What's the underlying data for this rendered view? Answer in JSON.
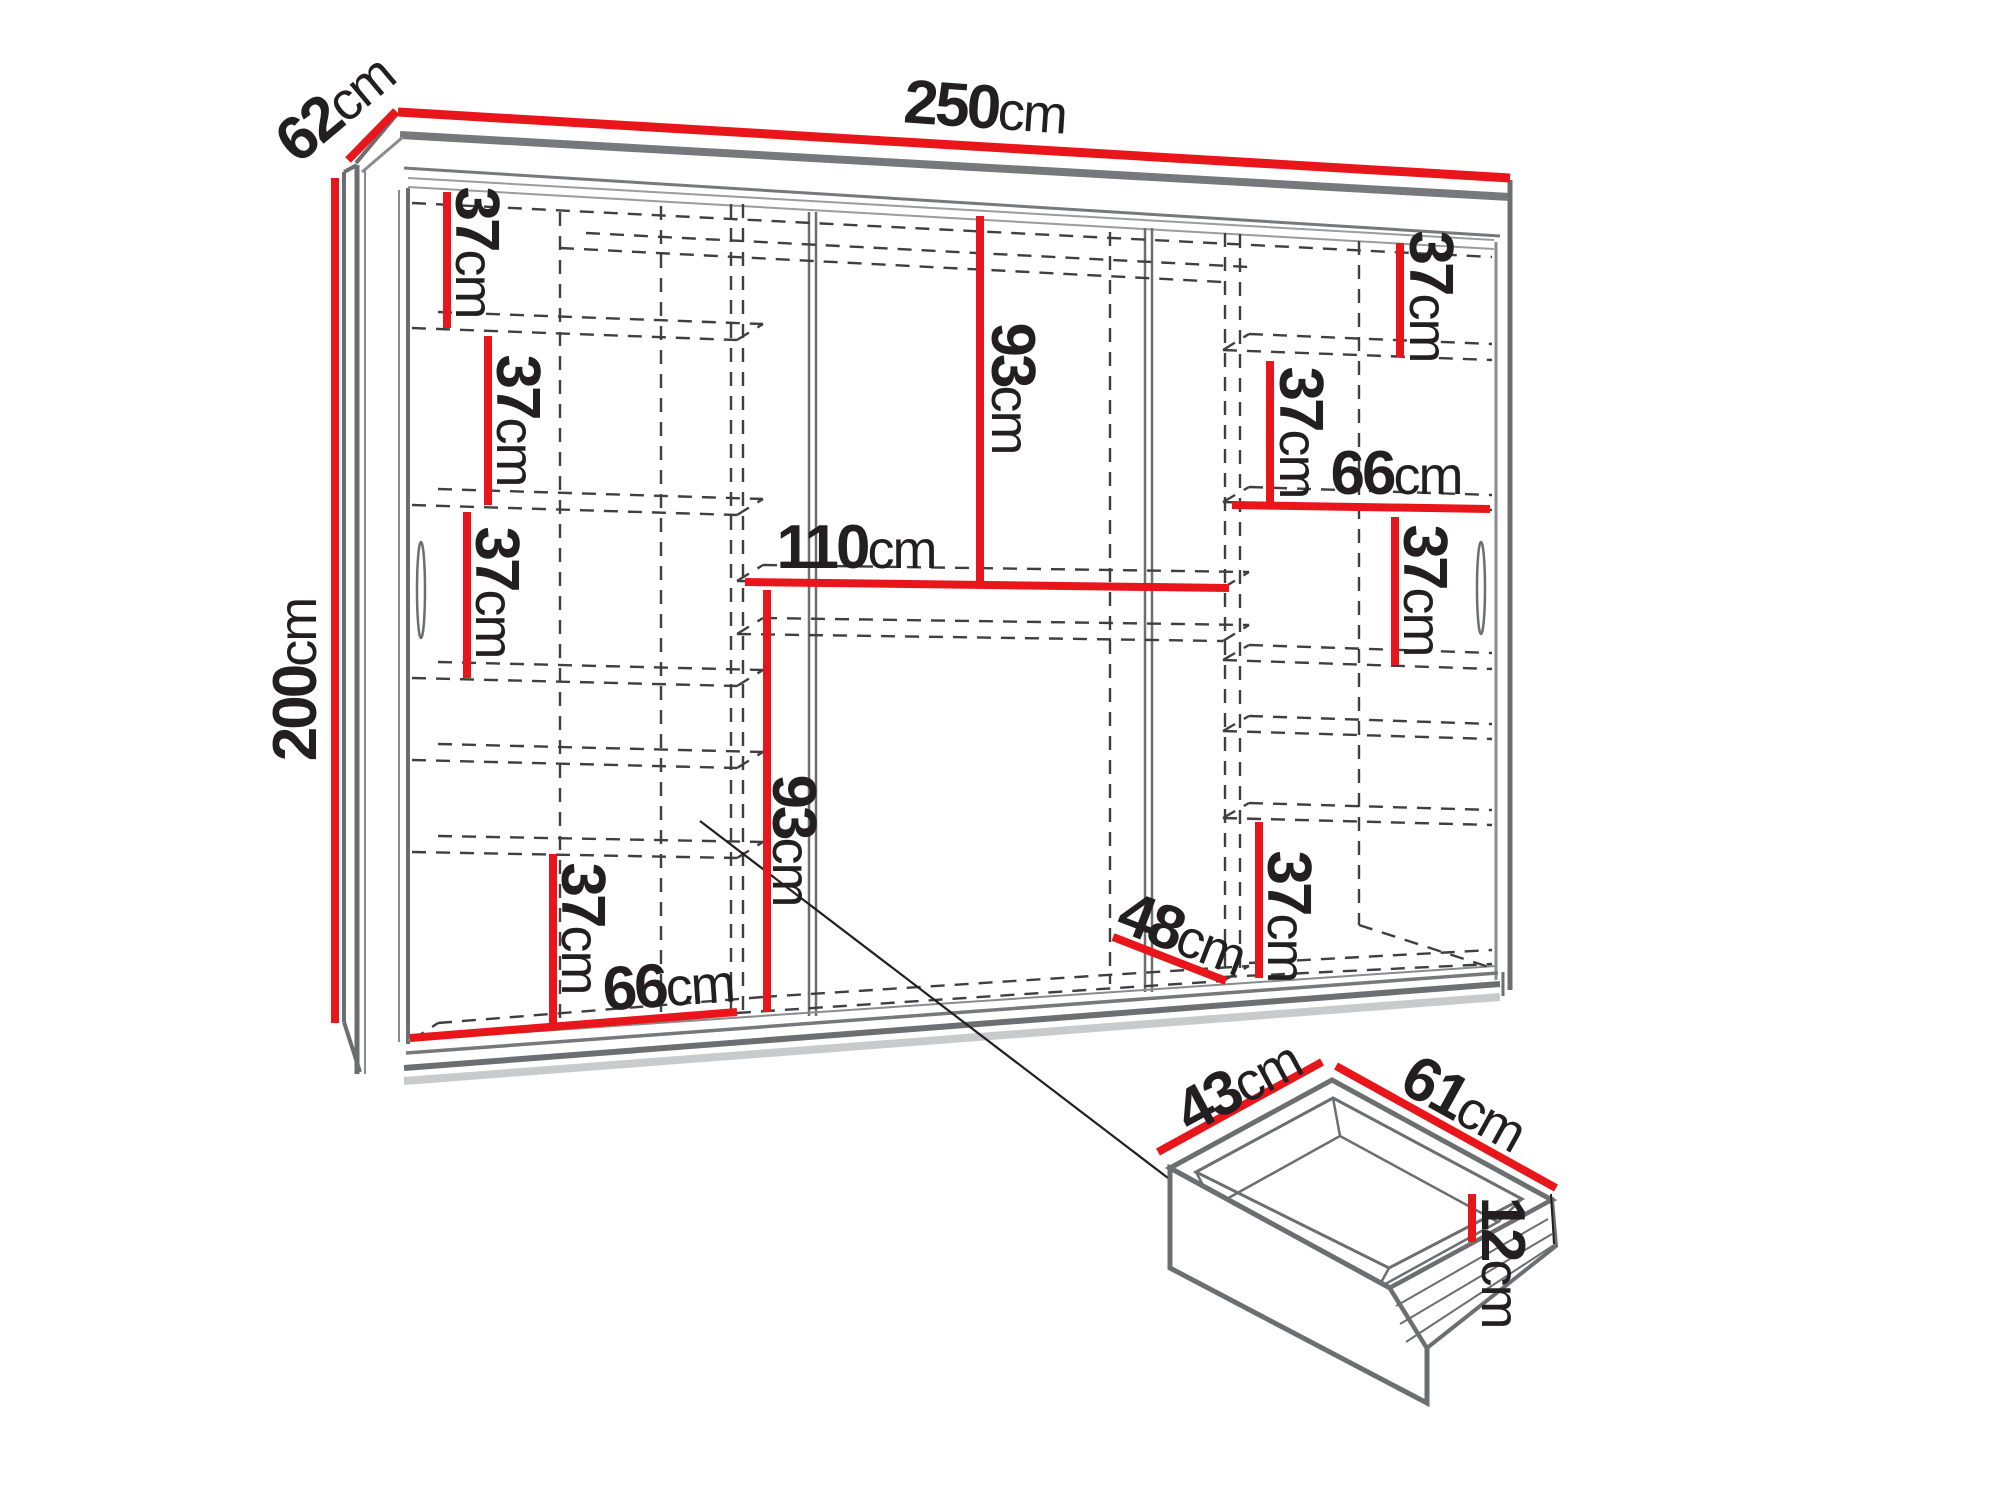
{
  "diagram": {
    "subject": "wardrobe-dimension-diagram",
    "accent_color": "#e8151b",
    "frame_color": "#6d6e71",
    "dash_color": "#3f3f41",
    "text_color": "#231f20"
  },
  "labels": {
    "wardrobe_width": {
      "value": "250",
      "unit": "cm"
    },
    "wardrobe_depth": {
      "value": "62",
      "unit": "cm"
    },
    "wardrobe_height": {
      "value": "200",
      "unit": "cm"
    },
    "left_gap_1": {
      "value": "37",
      "unit": "cm"
    },
    "left_gap_2": {
      "value": "37",
      "unit": "cm"
    },
    "left_gap_3": {
      "value": "37",
      "unit": "cm"
    },
    "left_gap_bottom": {
      "value": "37",
      "unit": "cm"
    },
    "left_section_width": {
      "value": "66",
      "unit": "cm"
    },
    "middle_top_height": {
      "value": "93",
      "unit": "cm"
    },
    "middle_shelf_width": {
      "value": "110",
      "unit": "cm"
    },
    "middle_bottom_height": {
      "value": "93",
      "unit": "cm"
    },
    "right_gap_1": {
      "value": "37",
      "unit": "cm"
    },
    "right_gap_2": {
      "value": "37",
      "unit": "cm"
    },
    "right_section_width": {
      "value": "66",
      "unit": "cm"
    },
    "right_gap_3": {
      "value": "37",
      "unit": "cm"
    },
    "right_gap_bottom": {
      "value": "37",
      "unit": "cm"
    },
    "floor_depth": {
      "value": "48",
      "unit": "cm"
    },
    "drawer_depth": {
      "value": "43",
      "unit": "cm"
    },
    "drawer_width": {
      "value": "61",
      "unit": "cm"
    },
    "drawer_height": {
      "value": "12",
      "unit": "cm"
    }
  }
}
